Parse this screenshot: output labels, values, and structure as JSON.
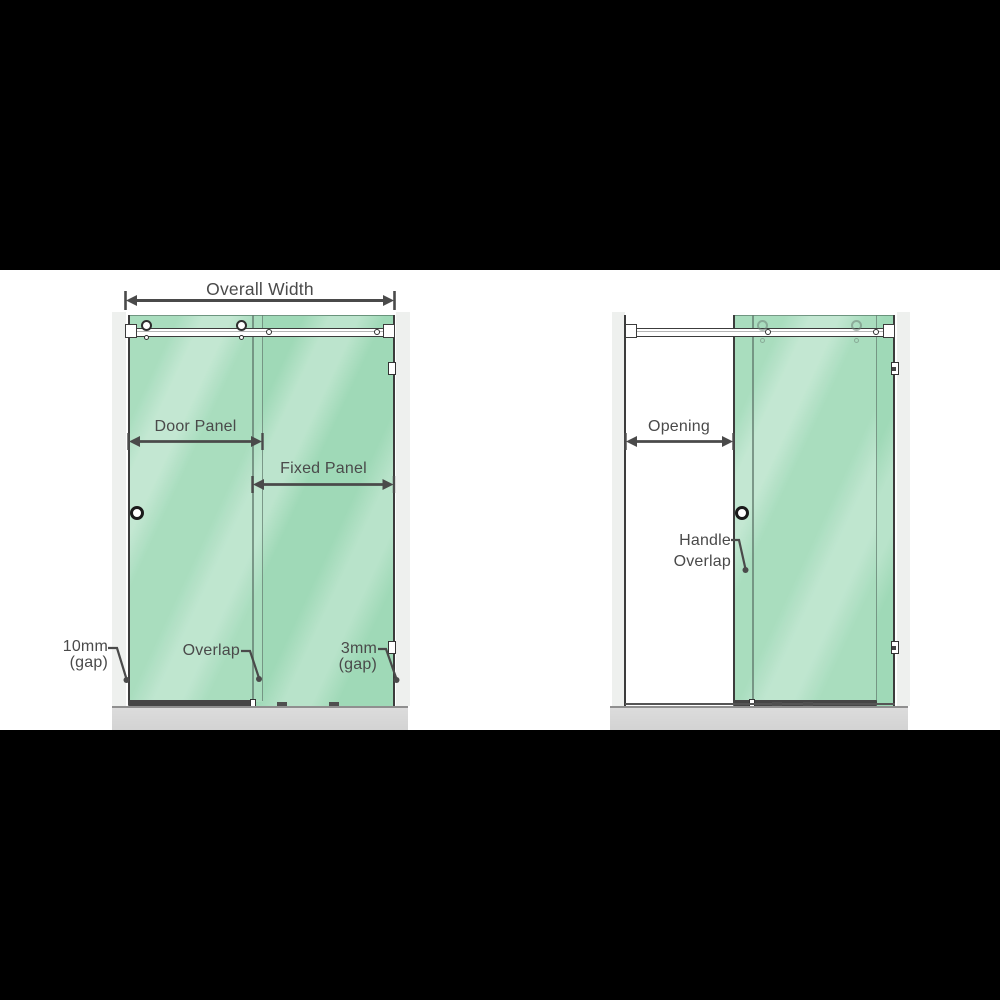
{
  "appearance": {
    "glass-green": "#9fd9b7",
    "wall-gray": "#eef0ee",
    "tray-gray": "#d3d3d3",
    "line-gray": "#4a4a4a",
    "hardware-dark": "#3c3c3c",
    "letterbox-black": "#000000"
  },
  "left_diagram": {
    "overall_width": {
      "label": "Overall Width"
    },
    "door_panel": {
      "label": "Door Panel"
    },
    "fixed_panel": {
      "label": "Fixed Panel"
    },
    "overlap": {
      "label": "Overlap"
    },
    "gap_left": {
      "line1": "10mm",
      "line2": "(gap)"
    },
    "gap_right": {
      "line1": "3mm",
      "line2": "(gap)"
    }
  },
  "right_diagram": {
    "opening": {
      "label": "Opening"
    },
    "handle_overlap": {
      "line1": "Handle",
      "line2": "Overlap"
    }
  }
}
